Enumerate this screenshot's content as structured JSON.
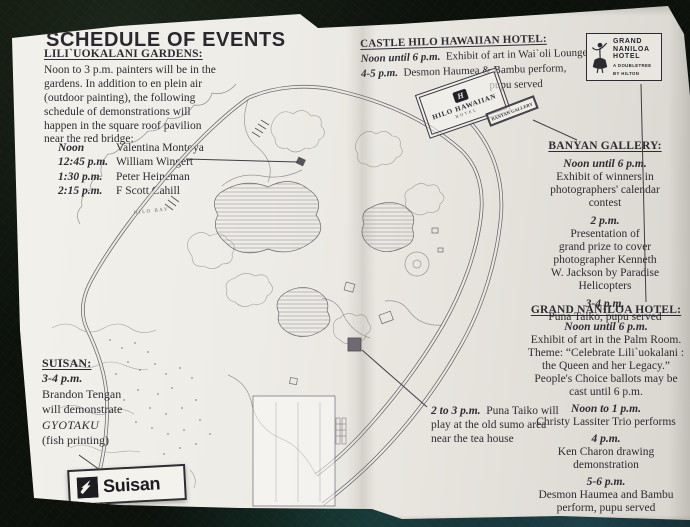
{
  "page": {
    "title": "SCHEDULE OF EVENTS"
  },
  "sections": {
    "gardens": {
      "heading": "LILI`UOKALANI GARDENS:",
      "body": [
        "Noon to 3 p.m. painters will be in the",
        "gardens.  In addition to en plein air",
        "(outdoor painting), the following",
        "schedule of demonstrations will",
        "happen in the square roof pavilion",
        "near the red bridge:"
      ],
      "schedule": [
        {
          "time": "Noon",
          "name": "Valentina Montoya"
        },
        {
          "time": "12:45 p.m.",
          "name": "William Wingert"
        },
        {
          "time": "1:30 p.m.",
          "name": "Peter Heineman"
        },
        {
          "time": "2:15 p.m.",
          "name": "F Scott Cahill"
        }
      ]
    },
    "castle": {
      "heading": "CASTLE HILO HAWAIIAN HOTEL:",
      "e1_time": "Noon until 6 p.m.",
      "e1_text": "Exhibit of art in Wai`oli Lounge",
      "e2_time": "4-5 p.m.",
      "e2_text": "Desmon Haumea & Bambu perform,",
      "e3_text": "pupu served"
    },
    "banyan": {
      "heading": "BANYAN GALLERY:",
      "events": [
        {
          "time": "Noon until 6 p.m.",
          "lines": [
            "Exhibit of winners in",
            "photographers' calendar",
            "contest"
          ]
        },
        {
          "time": "2 p.m.",
          "lines": [
            "Presentation of",
            "grand prize to cover",
            "photographer Kenneth",
            "W. Jackson by Paradise",
            "Helicopters"
          ]
        },
        {
          "time": "3-4 p.m.",
          "lines": [
            "Puna Taiko, pupu served"
          ]
        }
      ]
    },
    "naniloa": {
      "heading": "GRAND NANILOA HOTEL:",
      "events": [
        {
          "time": "Noon until 6 p.m.",
          "lines": [
            "Exhibit of art in the Palm Room.",
            "Theme: “Celebrate Lili`uokalani :",
            "the Queen and her Legacy.”",
            "People's Choice ballots may be",
            "cast until 6 p.m."
          ]
        },
        {
          "time": "Noon to 1 p.m.",
          "lines": [
            "Christy Lassiter Trio performs"
          ]
        },
        {
          "time": "4 p.m.",
          "lines": [
            "Ken Charon drawing",
            "demonstration"
          ]
        },
        {
          "time": "5-6 p.m.",
          "lines": [
            "Desmon Haumea and Bambu",
            "perform, pupu served"
          ]
        }
      ]
    },
    "suisan": {
      "heading": "SUISAN:",
      "time": "3-4 p.m.",
      "lines": [
        "Brandon Tengan",
        "will demonstrate"
      ],
      "italic": "GYOTAKU",
      "last": "(fish printing)"
    },
    "taiko": {
      "time": "2 to 3 p.m.",
      "rest": "Puna Taiko will",
      "line2": "play at the old sumo area",
      "line3": "near the tea house"
    }
  },
  "map": {
    "bay_label": "HILO BAY",
    "gallery_tag": "BANYAN GALLERY"
  },
  "logos": {
    "hilo_hawaiian": {
      "monogram": "H",
      "name": "HILO HAWAIIAN",
      "sub": "HOTEL"
    },
    "grand_naniloa": {
      "line1": "GRAND",
      "line2": "NANILOA",
      "line3": "HOTEL",
      "sub1": "A DOUBLETREE",
      "sub2": "BY HILTON"
    },
    "suisan": {
      "label": "Suisan"
    }
  },
  "colors": {
    "paper": "#eceae4",
    "background": "#0c110c",
    "ink": "#2e2c33",
    "map_line": "#56525c",
    "accent_teal": "#1d4049"
  }
}
